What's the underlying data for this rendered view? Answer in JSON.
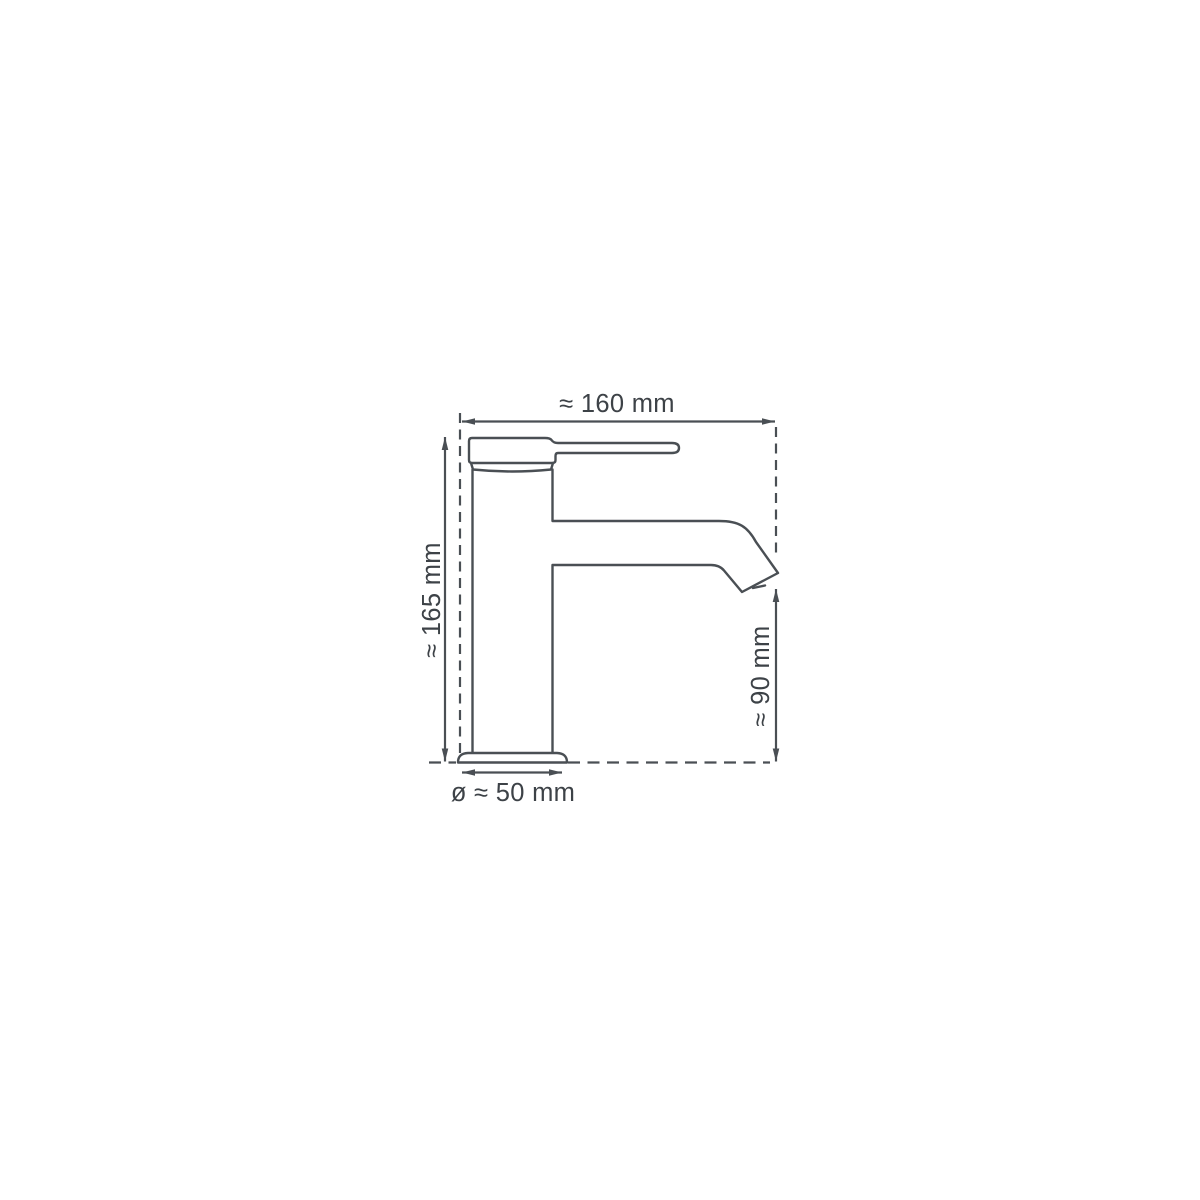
{
  "diagram": {
    "type": "technical-dimension-drawing",
    "subject": "single-lever basin mixer tap, side view",
    "background_color": "#ffffff",
    "line_color": "#4a4f54",
    "text_color": "#3d4247",
    "dimensions": {
      "overall_width": {
        "label": "≈ 160 mm",
        "value_mm": 160,
        "approx": true,
        "placement": "top-horizontal"
      },
      "overall_height": {
        "label": "≈ 165 mm",
        "value_mm": 165,
        "approx": true,
        "placement": "left-vertical-rotated"
      },
      "spout_height": {
        "label": "≈ 90 mm",
        "value_mm": 90,
        "approx": true,
        "placement": "right-vertical-rotated"
      },
      "base_diameter": {
        "label": "ø ≈ 50 mm",
        "value_mm": 50,
        "approx": true,
        "placement": "bottom-horizontal"
      }
    }
  }
}
